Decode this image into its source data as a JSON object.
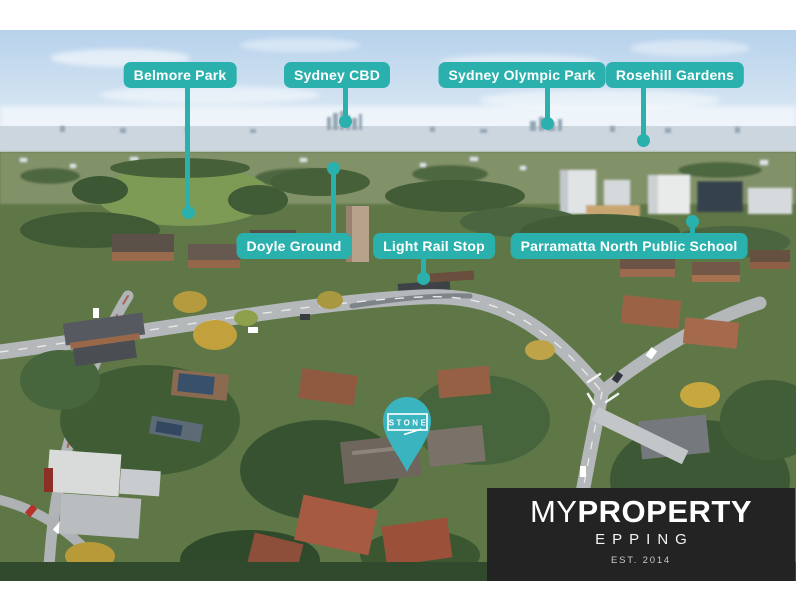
{
  "photo": {
    "description": "Aerial drone photograph of a leafy suburb with distant Sydney skyline, roads and apartment rooftops",
    "accent_teal": "#2bb1ad",
    "pin_teal": "#3ab5bf",
    "plate_background": "#232323"
  },
  "callouts": [
    {
      "text": "Belmore Park"
    },
    {
      "text": "Sydney CBD"
    },
    {
      "text": "Sydney Olympic Park"
    },
    {
      "text": "Rosehill Gardens"
    },
    {
      "text": "Doyle Ground"
    },
    {
      "text": "Light Rail Stop"
    },
    {
      "text": "Parramatta North Public School"
    }
  ],
  "pin": {
    "brand": "STONE"
  },
  "brand_plate": {
    "name_prefix": "MY",
    "name_suffix": "PROPERTY",
    "suburb": "EPPING",
    "established": "EST. 2014"
  }
}
